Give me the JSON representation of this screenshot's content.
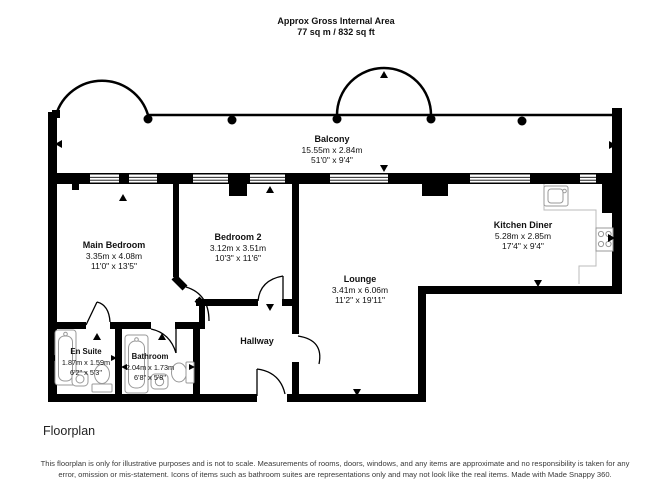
{
  "header": {
    "title": "Approx Gross Internal Area",
    "subtitle": "77 sq m / 832 sq ft"
  },
  "rooms": {
    "balcony": {
      "name": "Balcony",
      "metric": "15.55m x 2.84m",
      "imperial": "51'0\" x 9'4\""
    },
    "main_bedroom": {
      "name": "Main Bedroom",
      "metric": "3.35m x 4.08m",
      "imperial": "11'0\" x 13'5\""
    },
    "bedroom2": {
      "name": "Bedroom 2",
      "metric": "3.12m x 3.51m",
      "imperial": "10'3\" x 11'6\""
    },
    "kitchen_diner": {
      "name": "Kitchen Diner",
      "metric": "5.28m x 2.85m",
      "imperial": "17'4\" x 9'4\""
    },
    "lounge": {
      "name": "Lounge",
      "metric": "3.41m x 6.06m",
      "imperial": "11'2\" x 19'11\""
    },
    "hallway": {
      "name": "Hallway"
    },
    "en_suite": {
      "name": "En Suite",
      "metric": "1.87m x 1.59m",
      "imperial": "6'2\" x 5'3\""
    },
    "bathroom": {
      "name": "Bathroom",
      "metric": "2.04m x 1.73m",
      "imperial": "6'8\" x 5'8\""
    }
  },
  "footer": {
    "label": "Floorplan",
    "disclaimer": "This floorplan is only for illustrative purposes and is not to scale. Measurements of rooms, doors, windows, and any items are approximate and no responsibility is taken for any error, omission or mis-statement. Icons of items such as bathroom suites are representations only and may not look like the real items. Made with Made Snappy 360."
  },
  "colors": {
    "wall": "#000000",
    "background": "#ffffff",
    "fixture_outline": "#999999",
    "counter_outline": "#bbbbbb"
  }
}
